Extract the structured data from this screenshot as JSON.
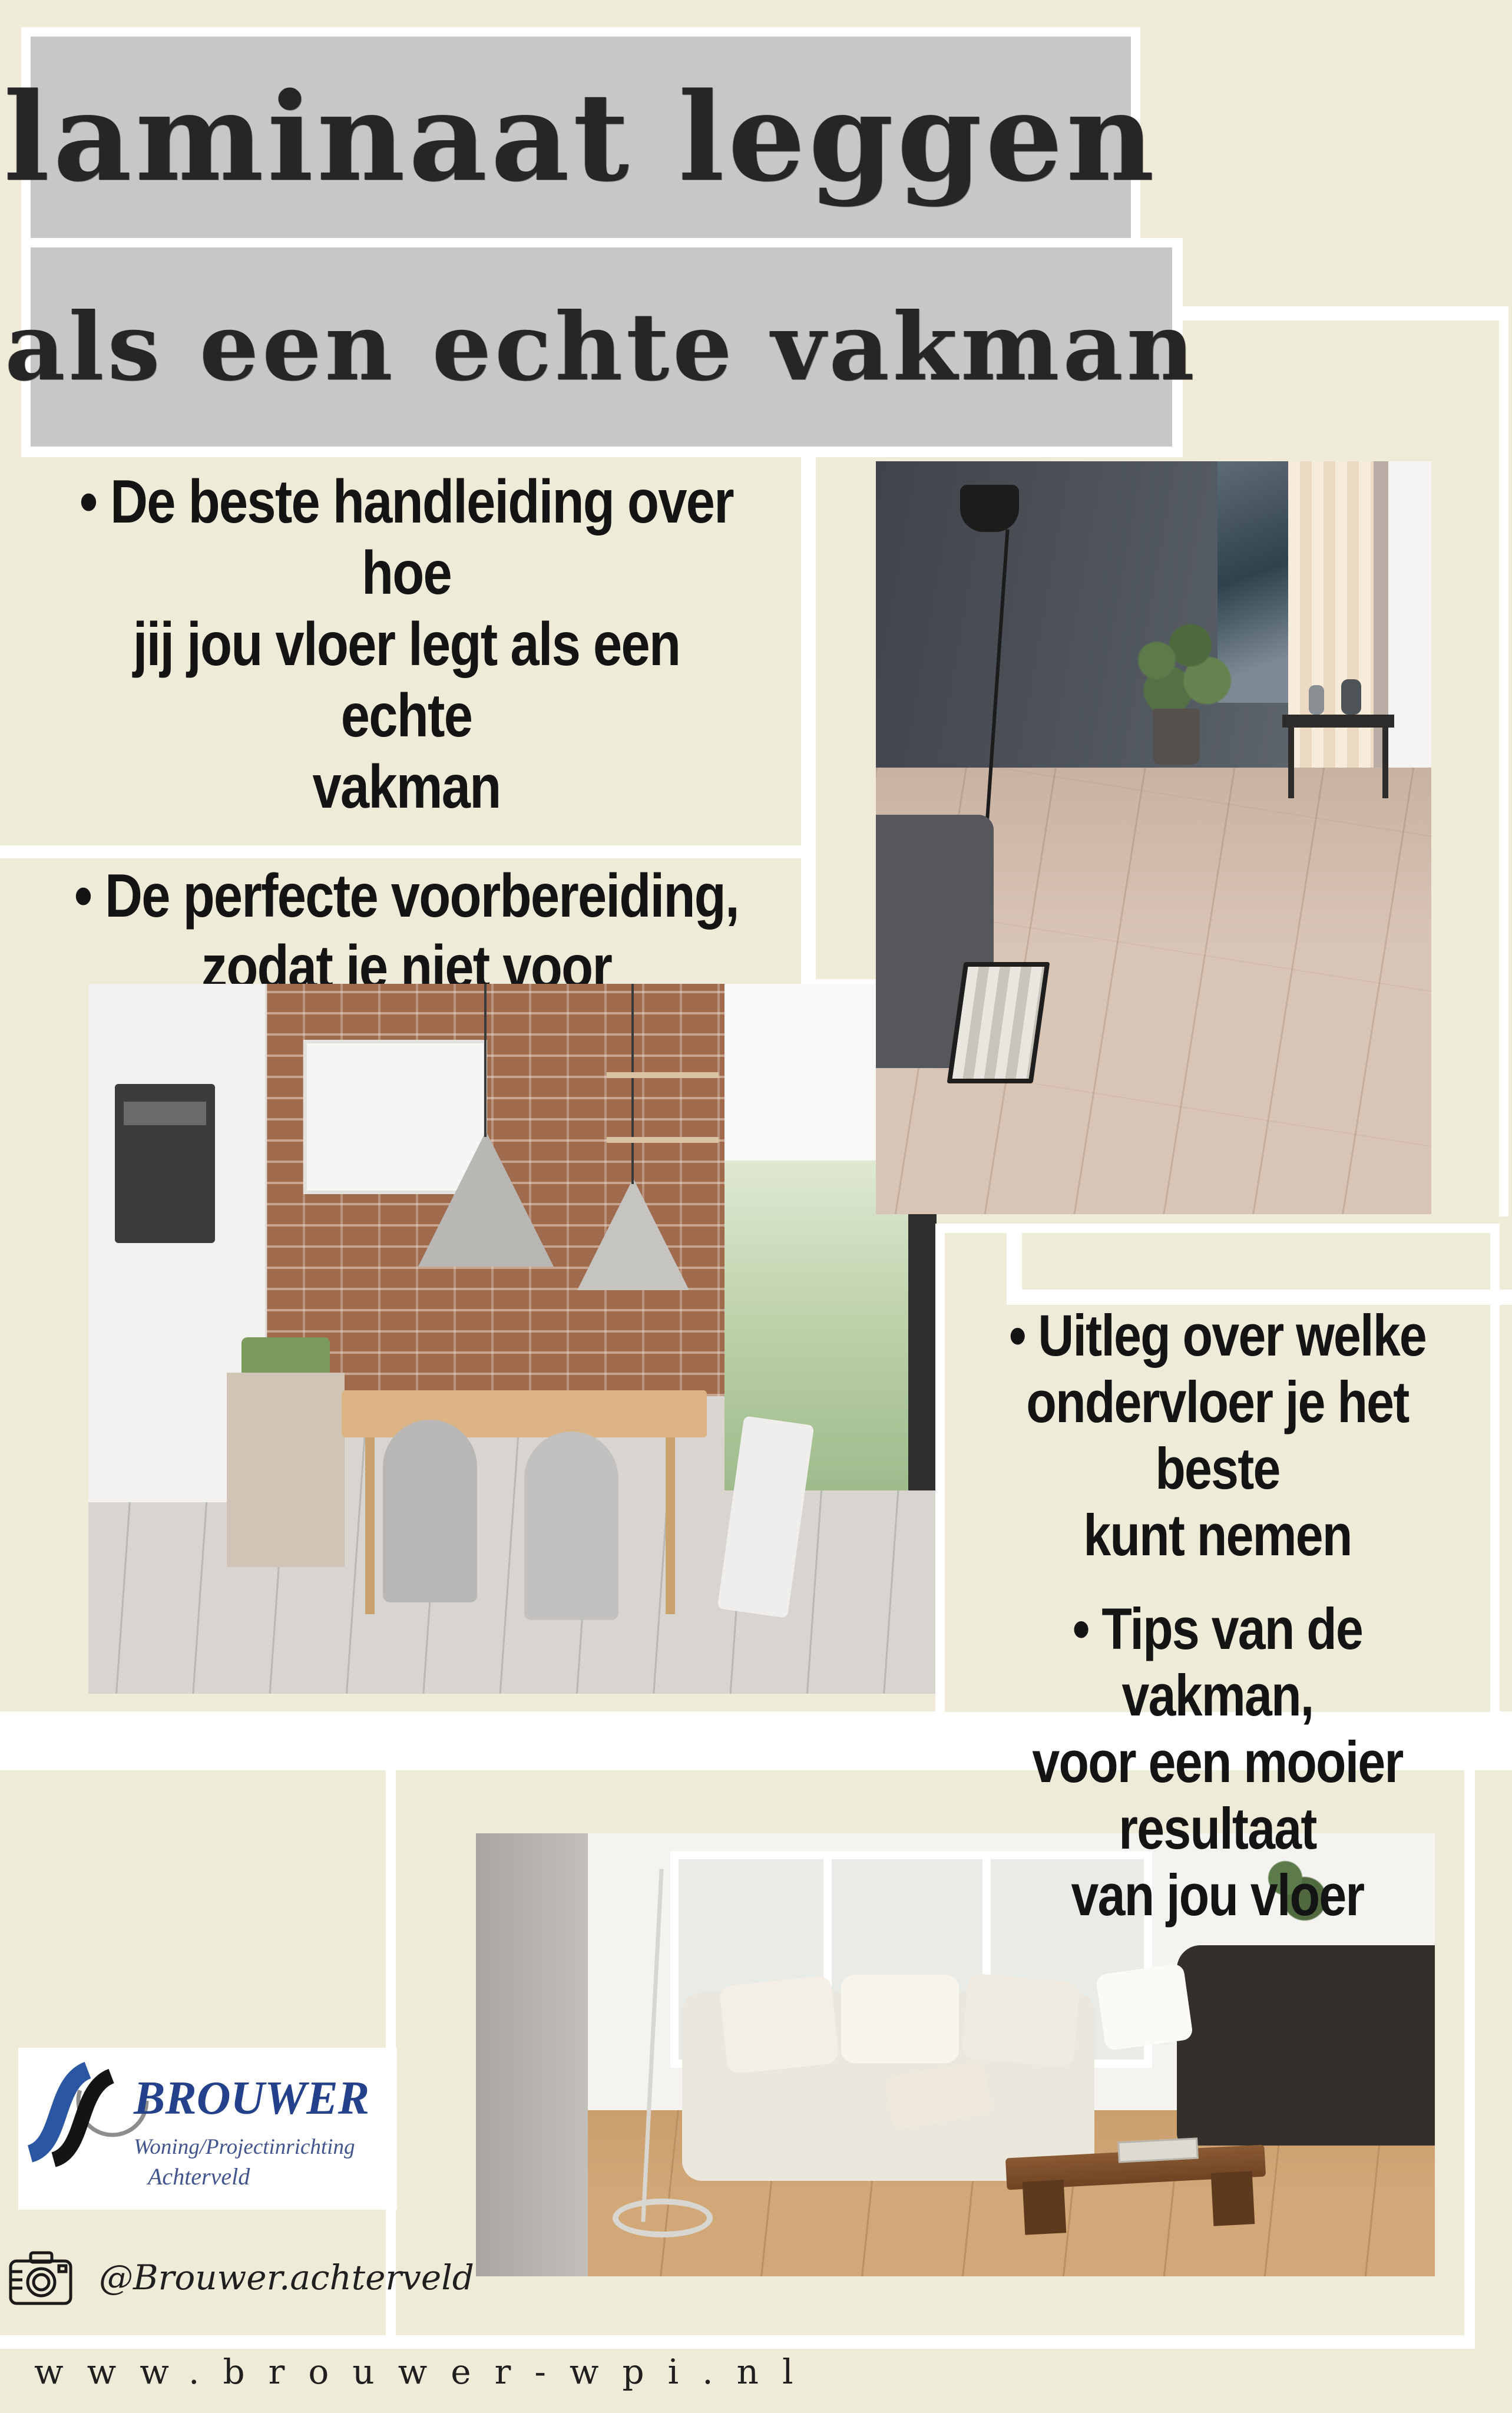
{
  "title": {
    "line1": "laminaat leggen",
    "line2": "als een echte vakman",
    "panel_color": "#c8c7c5",
    "text_color": "#262626"
  },
  "bullets_left": {
    "items": [
      {
        "lines": [
          "• De beste handleiding over hoe",
          "jij jou vloer legt als een echte",
          "vakman"
        ]
      },
      {
        "lines": [
          "• De perfecte voorbereiding,",
          "zodat je niet voor verassingen",
          "komt te staan"
        ]
      }
    ]
  },
  "bullets_right": {
    "items": [
      {
        "lines": [
          "•  Uitleg over welke",
          "ondervloer je het beste",
          "kunt nemen"
        ]
      },
      {
        "lines": [
          "•  Tips van de vakman,",
          "voor een mooier resultaat",
          "van jou vloer"
        ]
      }
    ]
  },
  "logo": {
    "brand": "BROUWER",
    "line1": "Woning/Projectinrichting",
    "line2": "Achterveld",
    "brand_color": "#24418c",
    "sub_color": "#41548e",
    "mark_blue": "#2b56a4",
    "mark_black": "#141414"
  },
  "social": {
    "icon": "camera-icon",
    "handle": "@Brouwer.achterveld"
  },
  "website": {
    "url": "www.brouwer-wpi.nl"
  },
  "colors": {
    "page_background": "#eeebd9",
    "panel_gray": "#c8c7c5",
    "gap_white": "#ffffff",
    "body_text": "#141414"
  }
}
